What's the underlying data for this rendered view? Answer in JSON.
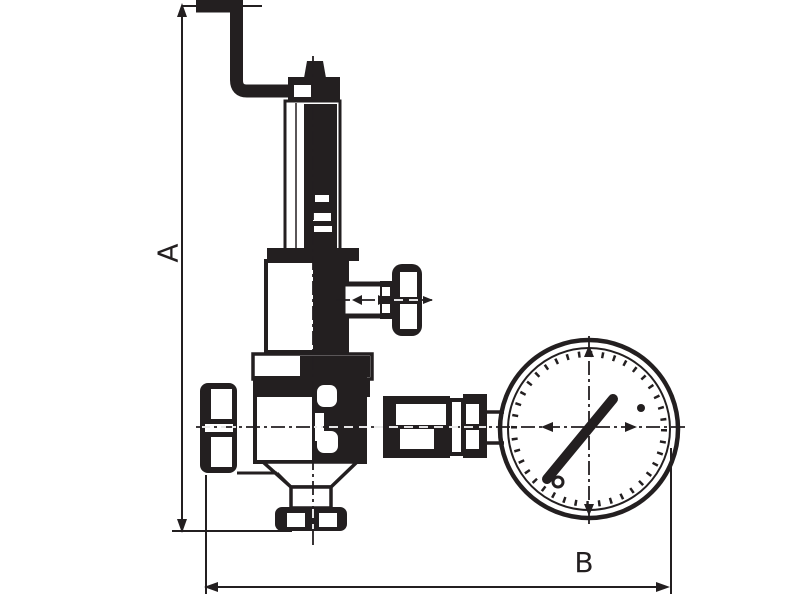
{
  "theme": {
    "background": "#ffffff",
    "line_color": "#231f20"
  },
  "drawing": {
    "kind": "technical dimension drawing",
    "dimension_labels": {
      "vertical": "A",
      "horizontal": "B"
    }
  }
}
